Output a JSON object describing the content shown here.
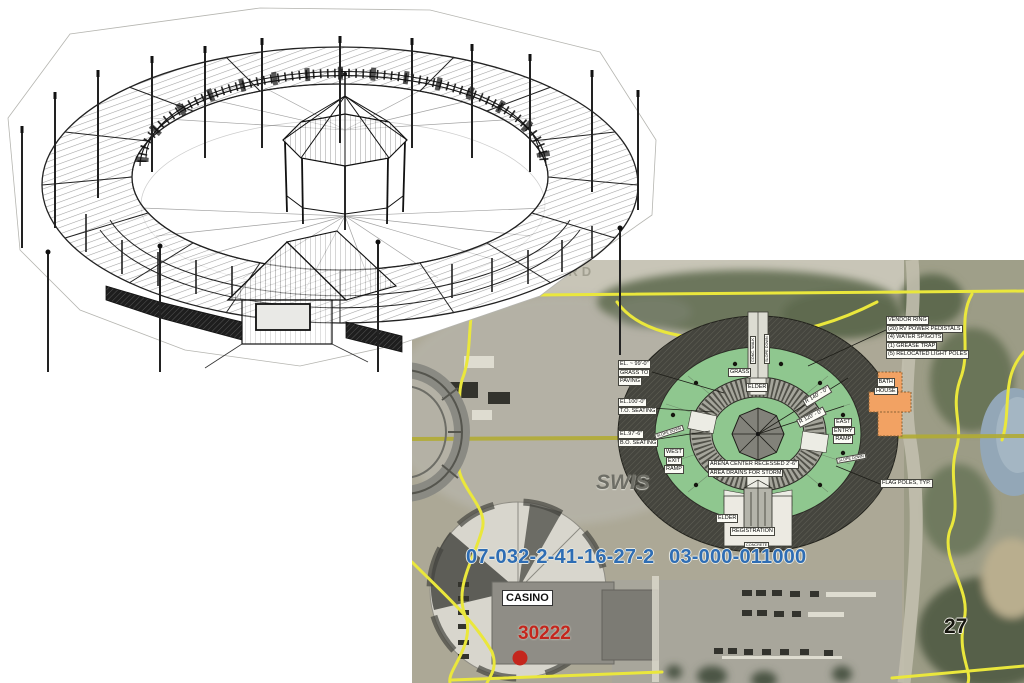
{
  "map": {
    "road_label": "SMEET RD",
    "labels": {
      "vendor_note": {
        "lines": [
          "VENDOR RING",
          "(20) RV POWER PEDISTALS",
          "(4) WATER SPIGOTS",
          "(1) GREASE TRAP",
          "(5) RELOCATED LIGHT POLES"
        ]
      },
      "bath_house": {
        "lines": [
          "BATH",
          "HOUSE"
        ]
      },
      "elevation_grass": {
        "lines": [
          "EL. ~ 99'-0\"",
          "GRASS TO",
          "PAVING"
        ]
      },
      "elevation_top_seating": {
        "lines": [
          "EL.100'-0\"",
          "T.O. SEATING"
        ]
      },
      "elevation_bottom_seating": {
        "lines": [
          "EL.97'-6\"",
          "B.O. SEATING"
        ]
      },
      "west_ramp": {
        "lines": [
          "WEST",
          "EXIT",
          "RAMP"
        ]
      },
      "east_ramp": {
        "lines": [
          "EAST",
          "ENTRY",
          "RAMP"
        ]
      },
      "slope_down": "SLOPE DOWN",
      "conc_walk": "CONC. WALK",
      "grass": "GRASS",
      "elder": "ELDER",
      "registration": "REGISTRATION",
      "concrete": "CONCRETE",
      "arena_note": {
        "lines": [
          "ARENA CENTER RECESSED 2'-6\"",
          "AREA DRAINS FOR STORM"
        ]
      },
      "radius_outer": "R 140' - 0\"",
      "radius_inner": "R 120' - 0\"",
      "flag_poles": "FLAG POLES, TYP."
    },
    "annotations": {
      "parcel_id": "07-032-2-41-16-27-2 03-000-011000",
      "swis": "SWIS",
      "casino": "CASINO",
      "point_id": "30222",
      "section_number": "27"
    },
    "colors": {
      "boundary_yellow": "#eae73c",
      "olive_line": "#b2ac34",
      "arena_green": "#8fc78f",
      "ring_dark": "#45453e",
      "bath_orange": "#f2a263",
      "parcel_blue": "#2e6db4",
      "point_red": "#c4261d"
    }
  }
}
